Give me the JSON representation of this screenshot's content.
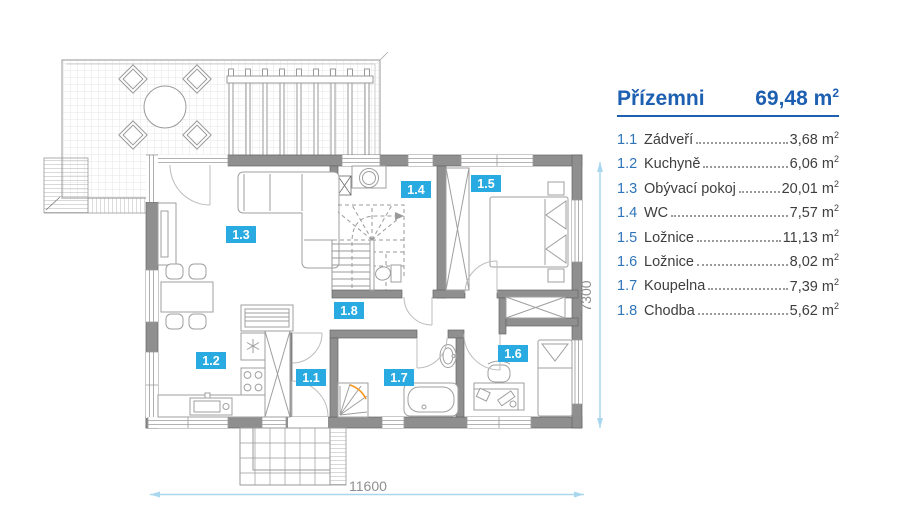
{
  "legend": {
    "title": "Přízemni",
    "total_area": "69,48",
    "unit_base": "m",
    "unit_exp": "2",
    "items": [
      {
        "number": "1.1",
        "name": "Zádveří",
        "area": "3,68"
      },
      {
        "number": "1.2",
        "name": "Kuchyně",
        "area": "6,06"
      },
      {
        "number": "1.3",
        "name": "Obývací pokoj",
        "area": "20,01"
      },
      {
        "number": "1.4",
        "name": "WC",
        "area": "7,57"
      },
      {
        "number": "1.5",
        "name": "Ložnice",
        "area": "11,13"
      },
      {
        "number": "1.6",
        "name": "Ložnice",
        "area": "8,02"
      },
      {
        "number": "1.7",
        "name": "Koupelna",
        "area": "7,39"
      },
      {
        "number": "1.8",
        "name": "Chodba",
        "area": "5,62"
      }
    ]
  },
  "dimensions": {
    "width": "11600",
    "height": "7300"
  },
  "colors": {
    "room_label_bg": "#29abe2",
    "legend_title_blue": "#1d5fb0",
    "legend_number_blue": "#2e74b9",
    "text_dark": "#3e3e3e",
    "wall_gray": "#8f8f8f",
    "line_gray": "#9a9a9a",
    "dimension_line_blue": "#a9d7ee",
    "dimension_text_gray": "#8f8f8f",
    "shower_accent_orange": "#f7941d"
  }
}
